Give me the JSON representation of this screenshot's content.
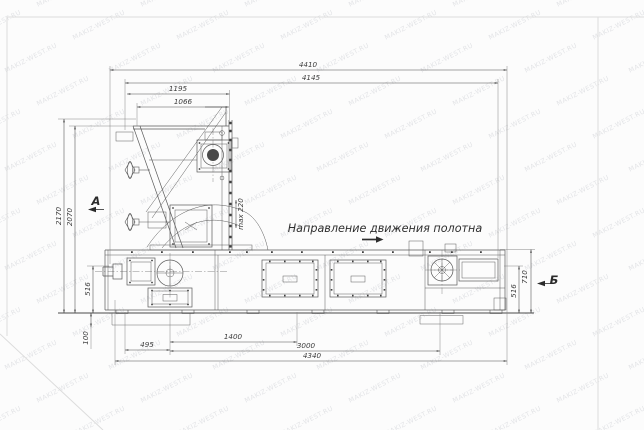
{
  "watermark": {
    "text": "MAKIZ-WEST.RU"
  },
  "annotations": {
    "direction_of_motion": "Направление движения полотна",
    "view_a": "А",
    "view_b": "Б",
    "max_clearance": "max 220"
  },
  "dimensions": {
    "overall_width": "4410",
    "width_4145": "4145",
    "hopper_1195": "1195",
    "hopper_1066": "1066",
    "overall_height": "2170",
    "height_2070": "2070",
    "belt_height_left": "516",
    "foot_100": "100",
    "bottom_495": "495",
    "bottom_1400": "1400",
    "bottom_3000": "3000",
    "bottom_4340": "4340",
    "right_710": "710",
    "belt_height_right": "516"
  }
}
